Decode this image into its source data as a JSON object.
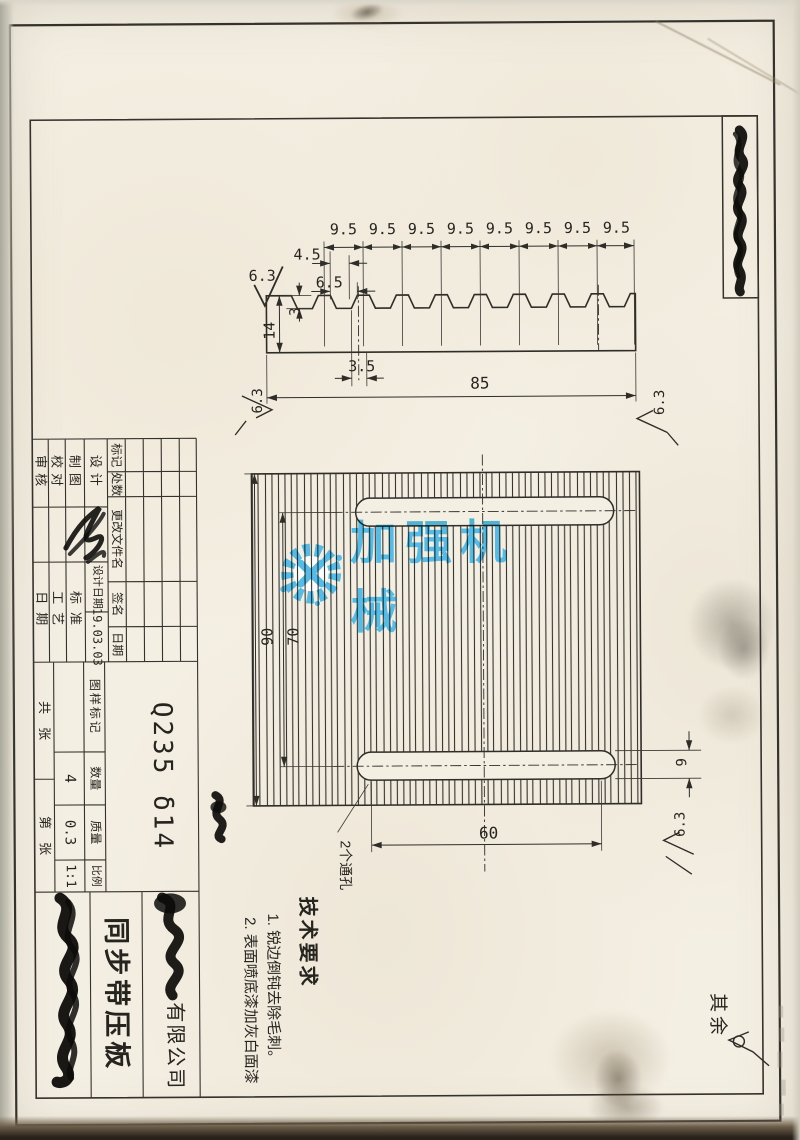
{
  "watermark": {
    "text": "加强机械"
  },
  "profile": {
    "pitch": [
      "9.5",
      "9.5",
      "9.5",
      "9.5",
      "9.5",
      "9.5",
      "9.5",
      "9.5"
    ],
    "d45": "4.5",
    "d65": "6.5",
    "d3": "3",
    "d14": "14",
    "d35": "3.5",
    "d85": "85",
    "rough_top": "6.3",
    "rough_left": "6.3",
    "rough_right": "6.3"
  },
  "plan": {
    "d90": "90",
    "d70": "70",
    "d60": "60",
    "d9": "9",
    "rough": "6.3",
    "holes": "2个通孔"
  },
  "tech": {
    "title": "技术要求",
    "item1": "1. 锐边倒钝去除毛刺。",
    "item2": "2. 表面喷底漆加灰白面漆"
  },
  "rest": {
    "label": "其余"
  },
  "tb": {
    "rev": {
      "mark": "标记",
      "count": "处数",
      "file": "更改文件名",
      "sign": "签名",
      "date": "日期"
    },
    "roles": {
      "design": "设计",
      "draft": "制图",
      "check": "校对",
      "audit": "审核"
    },
    "design_date_label": "设计日期",
    "design_date": "19.03.03",
    "aux": {
      "std": "标准",
      "proc": "工艺",
      "date": "日期"
    },
    "stamp": {
      "mark": "图样标记",
      "qty": "数量",
      "mass": "质量",
      "scale": "比例",
      "qty_v": "4",
      "mass_v": "0.3",
      "scale_v": "1:1"
    },
    "sheets": {
      "total": "共　张",
      "no": "第　张"
    },
    "material": "Q235 δ14",
    "part": "同步带压板",
    "company": "有限公司"
  }
}
